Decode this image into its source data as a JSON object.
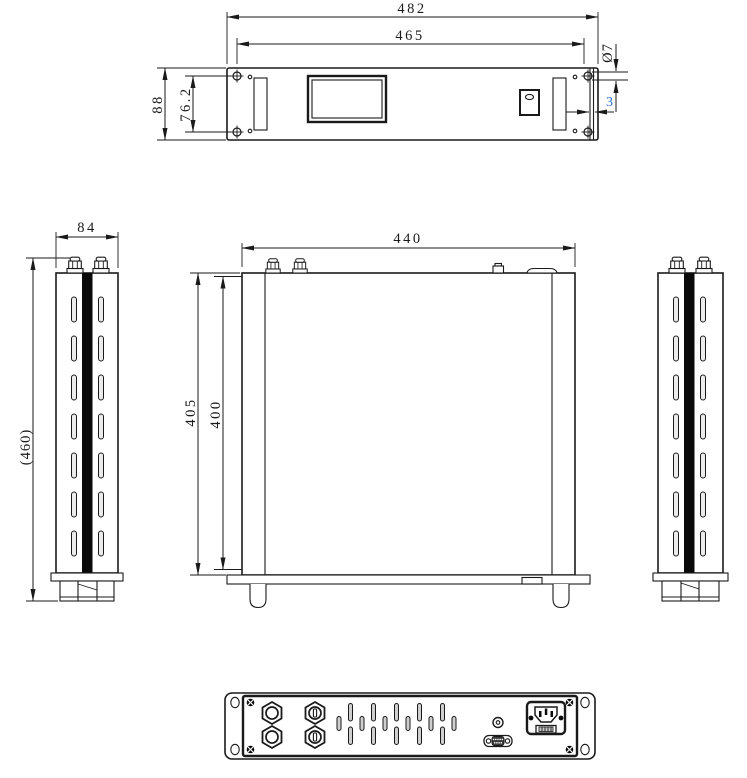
{
  "drawing": {
    "kind": "orthographic mechanical drawing of 2U 19-inch rack-mount chassis",
    "views": [
      "front",
      "left-side",
      "top",
      "right-side",
      "rear"
    ],
    "units": "mm"
  },
  "dims": {
    "overall_width": "482",
    "mount_hole_span": "465",
    "front_height": "88",
    "ear_hole_spacing": "76.2",
    "hole_diameter": "Ø7",
    "ear_thickness": "3",
    "side_width": "84",
    "total_height_ref": "(460)",
    "top_width": "440",
    "depth_overall": "405",
    "depth_body": "400"
  },
  "colors": {
    "line": "#1a1a1a",
    "highlight_dim": "#2b6fd0",
    "stripe": "#0a0a0a",
    "vent_fill": "#cfcfcf",
    "background": "#ffffff"
  }
}
